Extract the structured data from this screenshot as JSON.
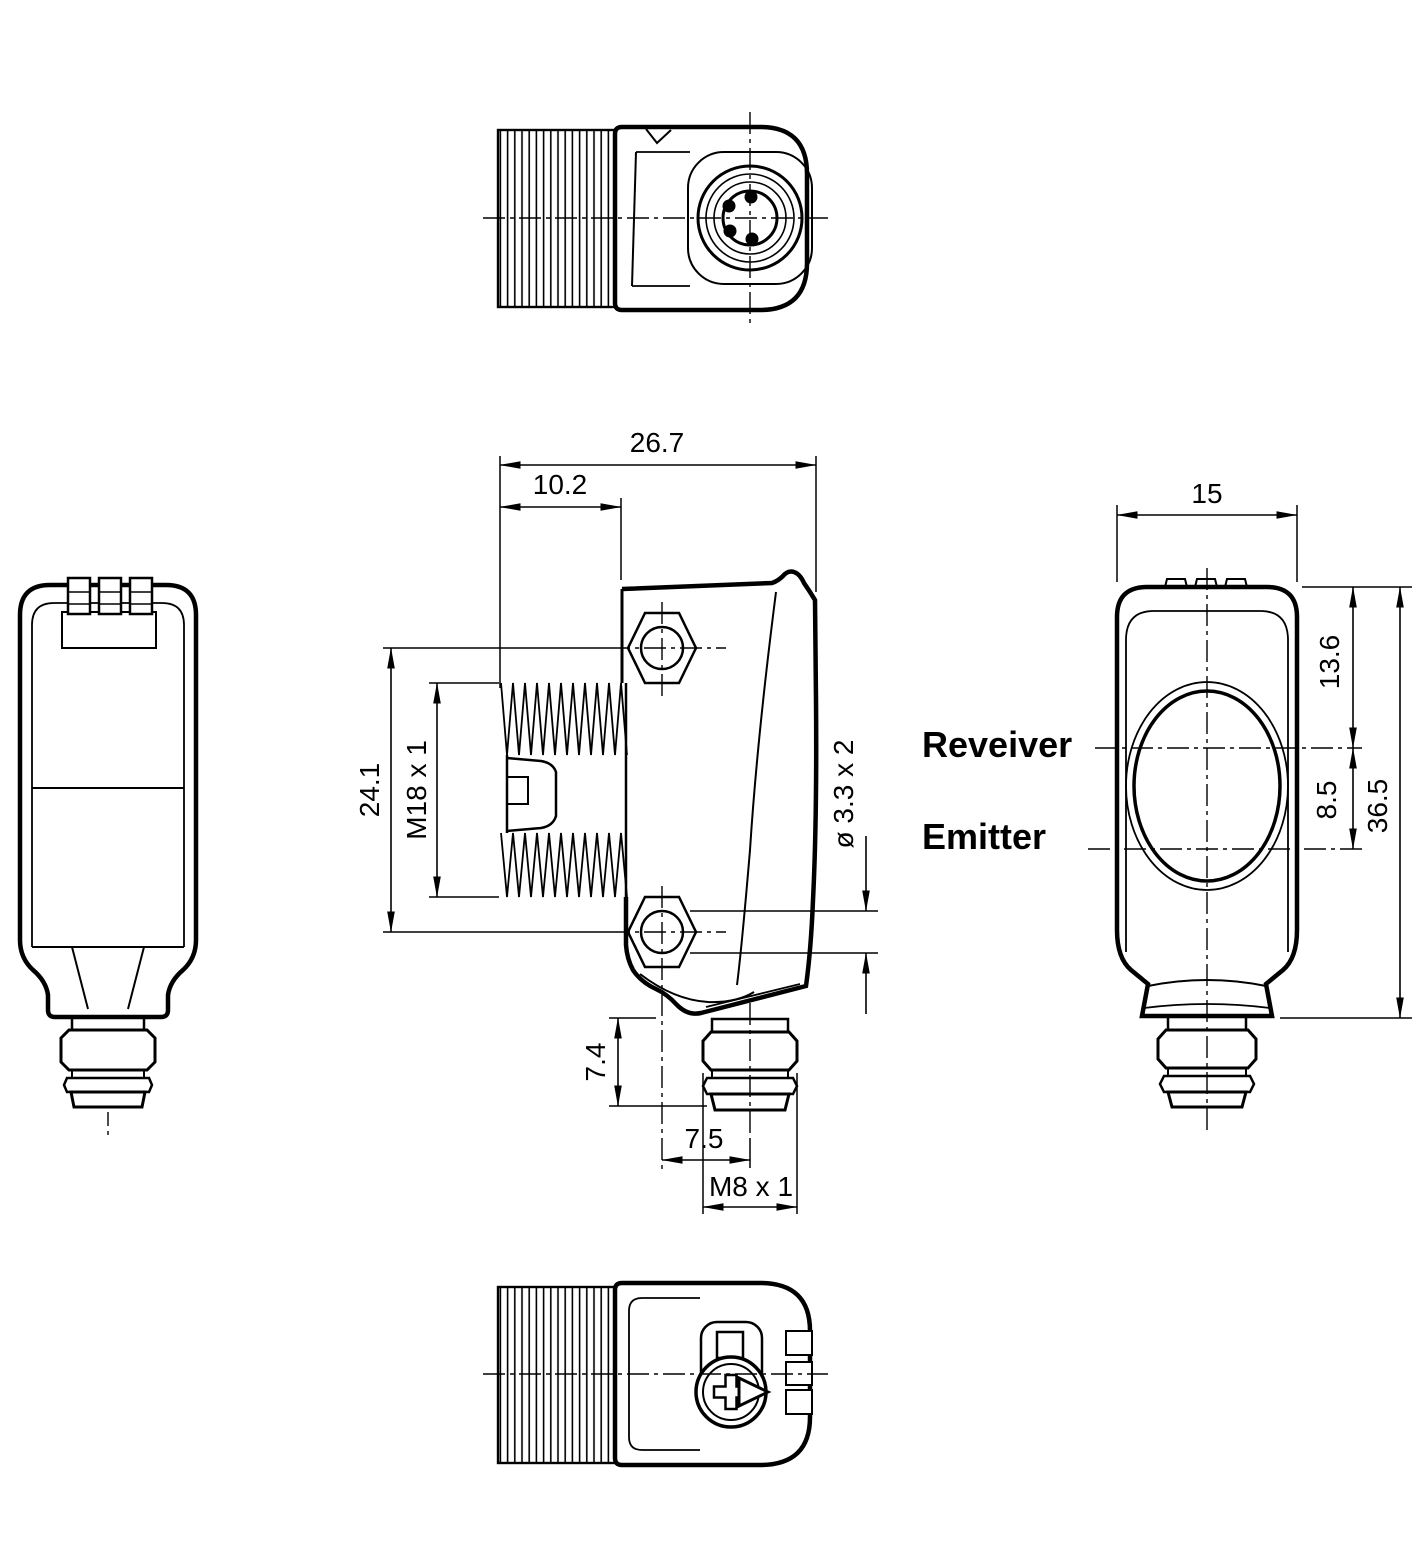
{
  "drawing": {
    "type": "technical-dimensional-drawing",
    "subject": "photoelectric sensor with M18 mounting studs and M8 connector",
    "colors": {
      "line": "#000000",
      "background": "#ffffff"
    },
    "labels": {
      "receiver": "Reveiver",
      "emitter": "Emitter"
    },
    "dimensions": {
      "front": {
        "overall_width": "26.7",
        "thread_length": "10.2",
        "hole_spacing": "24.1",
        "thread_spec": "M18 x 1",
        "mounting_holes": "ø 3.3 x 2",
        "connector_height": "7.4",
        "connector_offset": "7.5",
        "connector_thread": "M8 x 1"
      },
      "side": {
        "width": "15",
        "receiver_axis_depth": "13.6",
        "emitter_axis_spacing": "8.5",
        "height": "36.5"
      }
    }
  }
}
